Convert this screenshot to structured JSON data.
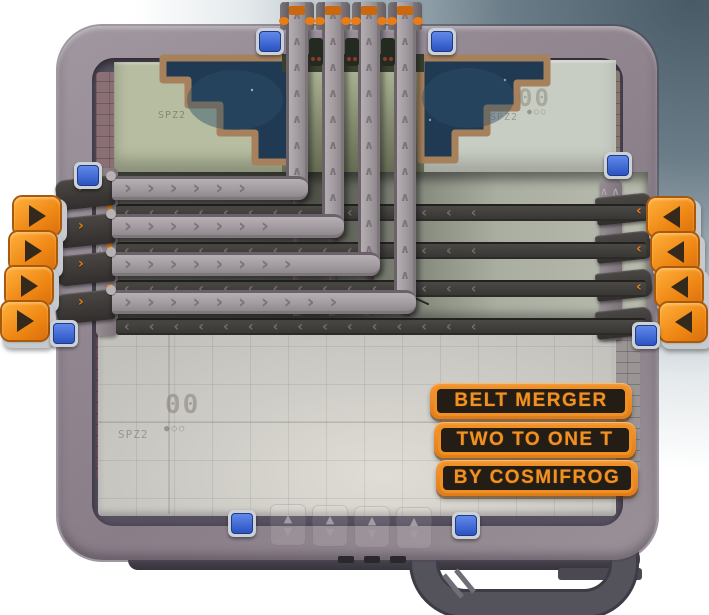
{
  "scene": {
    "name": "blueprint platform viewer",
    "grid_stamp": "SPZ2"
  },
  "signs": [
    {
      "label": "BELT MERGER"
    },
    {
      "label": "TWO TO ONE T"
    },
    {
      "label": "BY COSMIFROG"
    }
  ],
  "platform_marks": {
    "upper_left_label": "SPZ2",
    "upper_right_number": "00",
    "upper_right_label": "SPZ2",
    "upper_right_dots": "●○○",
    "lower_number": "00",
    "lower_label": "SPZ2",
    "lower_dots": "●○○"
  },
  "belts": {
    "chevron_right": "›",
    "chevron_left": "‹",
    "chevron_up": "∧",
    "left_input_rows": 4,
    "right_input_rows": 4,
    "top_output_columns": 4
  },
  "ports": {
    "left_inputs": [
      {
        "id": "left-input-1",
        "direction": "right"
      },
      {
        "id": "left-input-2",
        "direction": "right"
      },
      {
        "id": "left-input-3",
        "direction": "right"
      },
      {
        "id": "left-input-4",
        "direction": "right"
      }
    ],
    "right_inputs": [
      {
        "id": "right-input-1",
        "direction": "left"
      },
      {
        "id": "right-input-2",
        "direction": "left"
      },
      {
        "id": "right-input-3",
        "direction": "left"
      },
      {
        "id": "right-input-4",
        "direction": "left"
      }
    ],
    "top_outputs": [
      {
        "id": "top-output-1"
      },
      {
        "id": "top-output-2"
      },
      {
        "id": "top-output-3"
      },
      {
        "id": "top-output-4"
      }
    ],
    "bottom_lifts": [
      {
        "id": "bottom-lift-1",
        "up": "▲",
        "down": "▼"
      },
      {
        "id": "bottom-lift-2",
        "up": "▲",
        "down": "▼"
      },
      {
        "id": "bottom-lift-3",
        "up": "▲",
        "down": "▼"
      },
      {
        "id": "bottom-lift-4",
        "up": "▲",
        "down": "▼"
      }
    ]
  },
  "buttons": {
    "blue_toggles": [
      {
        "id": "toggle-top-left"
      },
      {
        "id": "toggle-top-right"
      },
      {
        "id": "toggle-left-upper"
      },
      {
        "id": "toggle-left-lower"
      },
      {
        "id": "toggle-right-upper"
      },
      {
        "id": "toggle-right-lower"
      },
      {
        "id": "toggle-bottom-left"
      },
      {
        "id": "toggle-bottom-right"
      }
    ]
  },
  "colors": {
    "accent_orange": "#ef8a1c",
    "button_blue": "#3a63d2",
    "void_navy": "#1f3a52",
    "void_border_tan": "#a6815c",
    "belt_light": "#a49da2",
    "belt_dark": "#434140",
    "rim_grey": "#928791"
  }
}
